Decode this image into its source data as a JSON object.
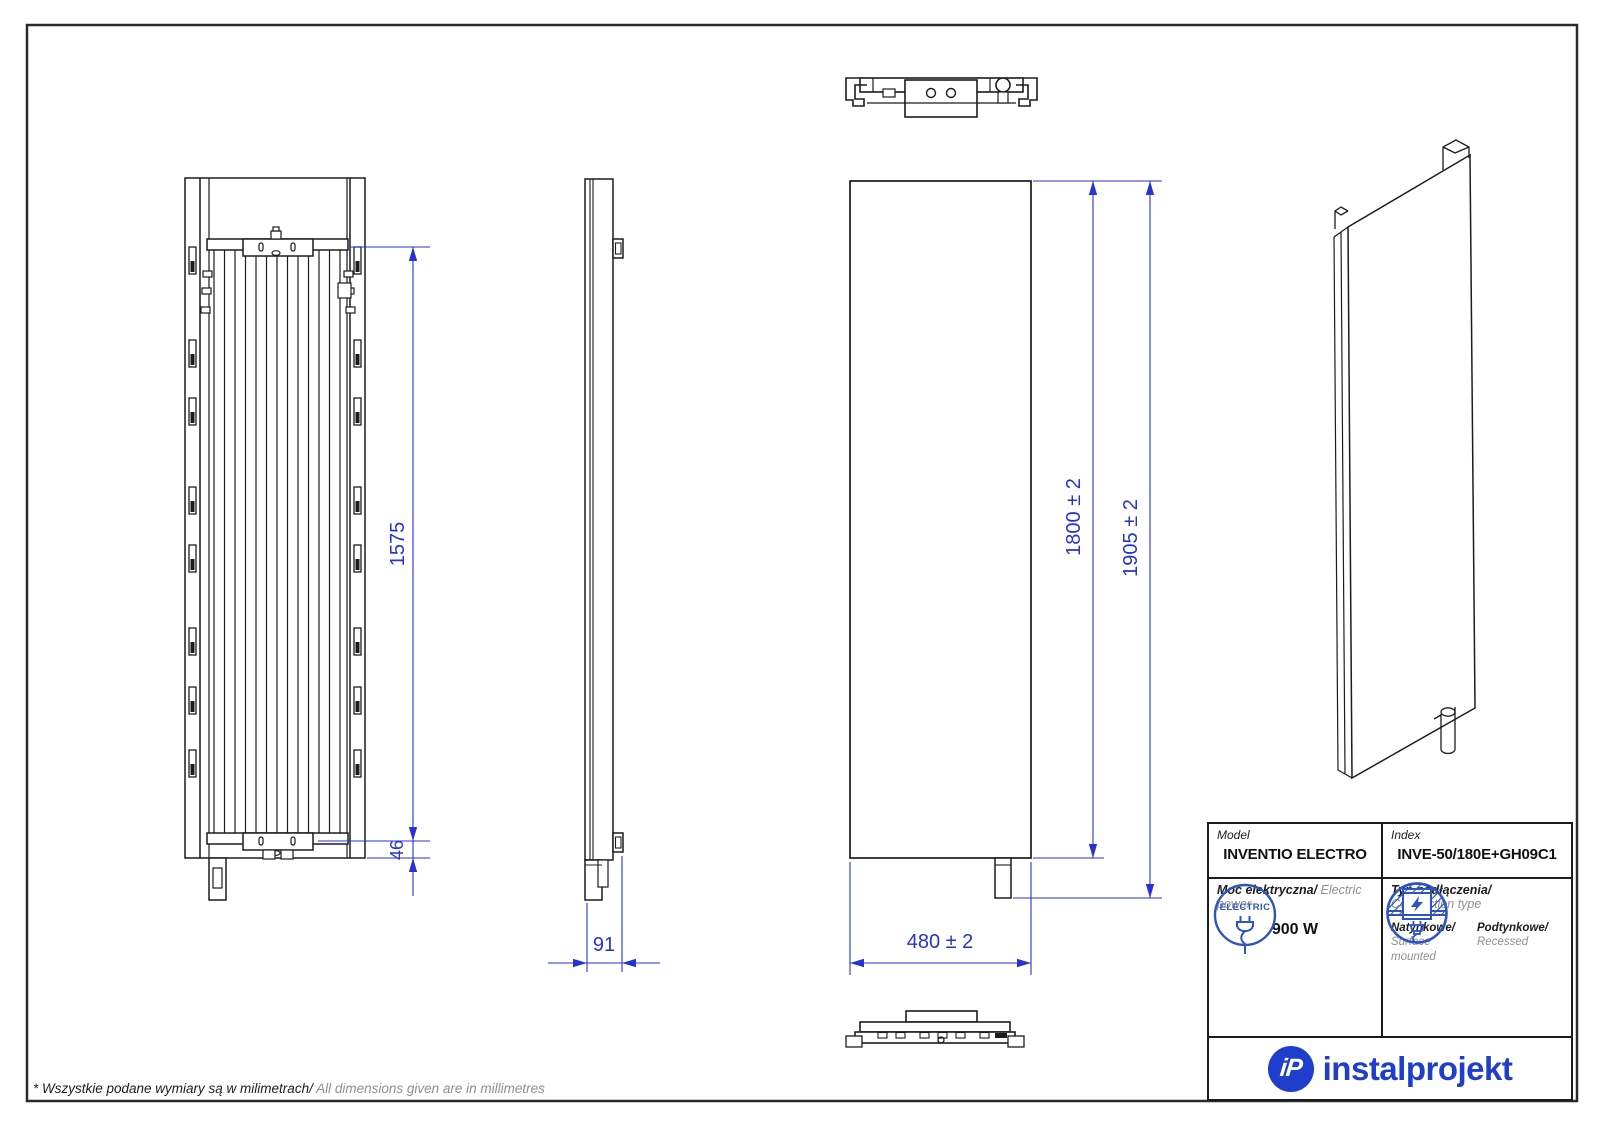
{
  "sheet": {
    "footer_note_pl": "* Wszystkie podane wymiary są w milimetrach/",
    "footer_note_en": " All dimensions given are in millimetres"
  },
  "dimensions": {
    "front_height": "1575",
    "bottom_offset": "46",
    "depth": "91",
    "panel_height": "1800 ± 2",
    "overall_height": "1905 ± 2",
    "width": "480 ± 2"
  },
  "spec_table": {
    "model_label": "Model",
    "model_value": "INVENTIO ELECTRO",
    "index_label": "Index",
    "index_value": "INVE-50/180E+GH09C1",
    "power_label_pl": "Moc elektryczna/",
    "power_label_en": " Electric power",
    "electric_badge": "ELECTRIC",
    "power_value": "900 W",
    "connection_label_pl": "Typ podłączenia/",
    "connection_label_en": "Connection type",
    "surface_label_pl": "Natynkowe/",
    "surface_label_en": "Surface mounted",
    "recessed_label_pl": "Podtynkowe/",
    "recessed_label_en": "Recessed"
  },
  "brand": {
    "monogram": "iP",
    "name": "instalprojekt"
  },
  "colors": {
    "dimension_blue": "#2733cd",
    "icon_blue": "#2e54c3",
    "logo_blue": "#1e3ecb",
    "line_black": "#1c1c1c",
    "muted_gray": "#8f8f8f"
  }
}
